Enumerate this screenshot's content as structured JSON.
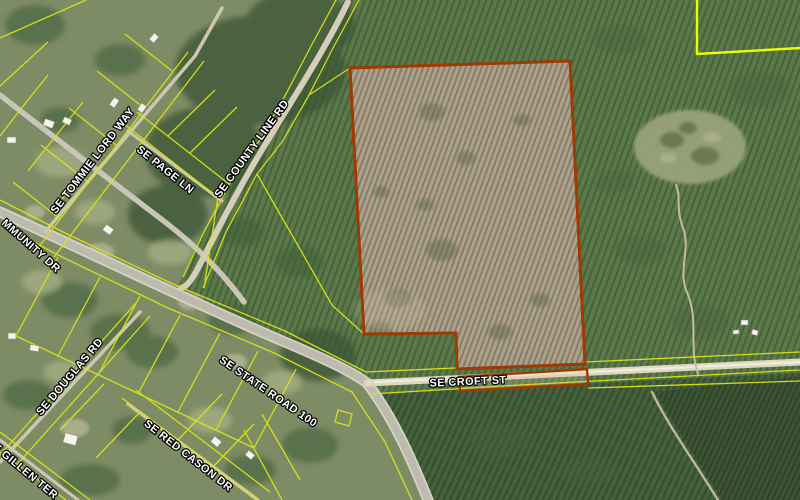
{
  "map": {
    "type": "aerial-parcel-map",
    "road_labels": [
      {
        "id": "community-dr",
        "text": "MMUNITY DR"
      },
      {
        "id": "tommie-lord-way",
        "text": "SE TOMMIE LORD WAY"
      },
      {
        "id": "page-ln",
        "text": "SE PAGE LN"
      },
      {
        "id": "county-line-rd",
        "text": "SE COUNTY LINE RD"
      },
      {
        "id": "douglas-rd",
        "text": "SE DOUGLAS RD"
      },
      {
        "id": "state-road-100",
        "text": "SE STATE ROAD 100"
      },
      {
        "id": "croft-st",
        "text": "SE CROFT ST"
      },
      {
        "id": "red-cason-dr",
        "text": "SE RED CASON DR"
      },
      {
        "id": "gillen-ter",
        "text": "SE GILLEN TER"
      }
    ],
    "highlighted_parcel": {
      "description": "large cleared parcel outlined in orange north of SE Croft St, plus narrow strip along south side of SE Croft St",
      "boundary_color": "#9e3a02"
    },
    "colors": {
      "parcel_line_yellow": "#d9e414",
      "bright_corner_yellow": "#eaff00",
      "highlight_boundary_orange": "#9e3a02",
      "pine_plantation_green": "#5c7a49",
      "cleared_parcel_tan": "#aba08c",
      "road_gray": "#c6c4b6",
      "dirt_road_tan": "#ded8c3",
      "label_text": "#ffffff",
      "label_outline": "#000000"
    }
  }
}
